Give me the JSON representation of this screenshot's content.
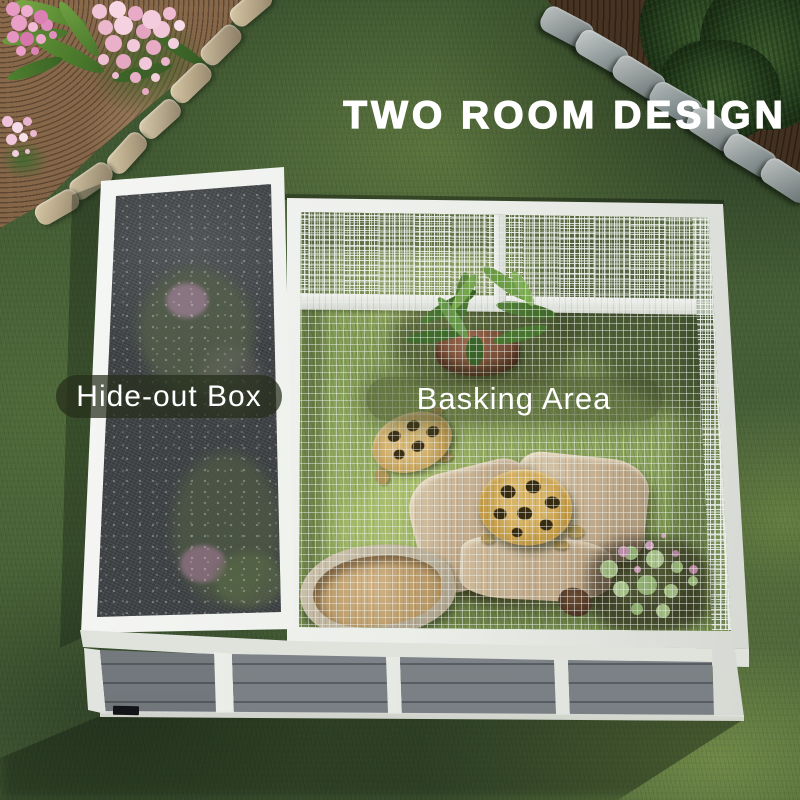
{
  "overlay": {
    "heading": "TWO ROOM DESIGN",
    "left_room_label": "Hide-out Box",
    "right_room_label": "Basking Area"
  },
  "colors": {
    "heading_text": "#ffffff",
    "label_text": "#ffffff",
    "label_pill_background": "rgba(42,50,28,0.65)",
    "enclosure_frame_white": "#eff1ed",
    "front_panel_gray": "#878d93",
    "hideout_screen_dark": "#3a3d40",
    "lawn_green": "#44603a"
  }
}
